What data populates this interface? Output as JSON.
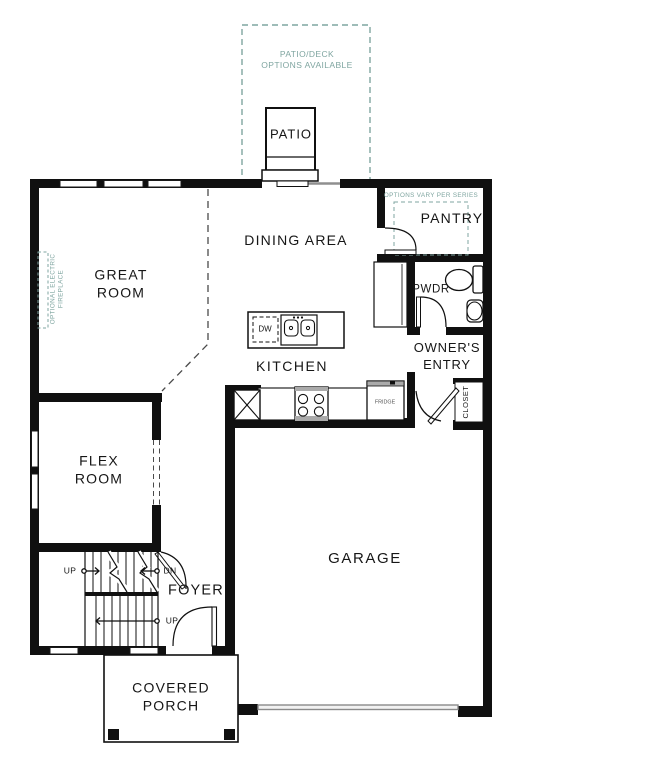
{
  "palette": {
    "wall": "#101010",
    "teal": "#7fa5a0",
    "gray": "#8f8f8f",
    "appliance_gray": "#aaaaaa"
  },
  "notes": {
    "patio_deck": "PATIO/DECK\nOPTIONS AVAILABLE",
    "options_vary": "OPTIONS VARY PER SERIES",
    "fireplace": "OPTIONAL ELECTRIC\nFIREPLACE"
  },
  "rooms": {
    "patio": "PATIO",
    "pantry": "PANTRY",
    "dining": "DINING AREA",
    "great_room": "GREAT\nROOM",
    "pwdr": "PWDR",
    "owners_entry": "OWNER'S\nENTRY",
    "kitchen": "KITCHEN",
    "closet": "CLOSET",
    "flex_room": "FLEX\nROOM",
    "garage": "GARAGE",
    "foyer": "FOYER",
    "covered_porch": "COVERED\nPORCH"
  },
  "fixtures": {
    "dishwasher": "DW",
    "fridge": "FRIDGE"
  },
  "stairs": {
    "up_upper": "UP",
    "down_upper": "DN",
    "up_lower": "UP"
  }
}
